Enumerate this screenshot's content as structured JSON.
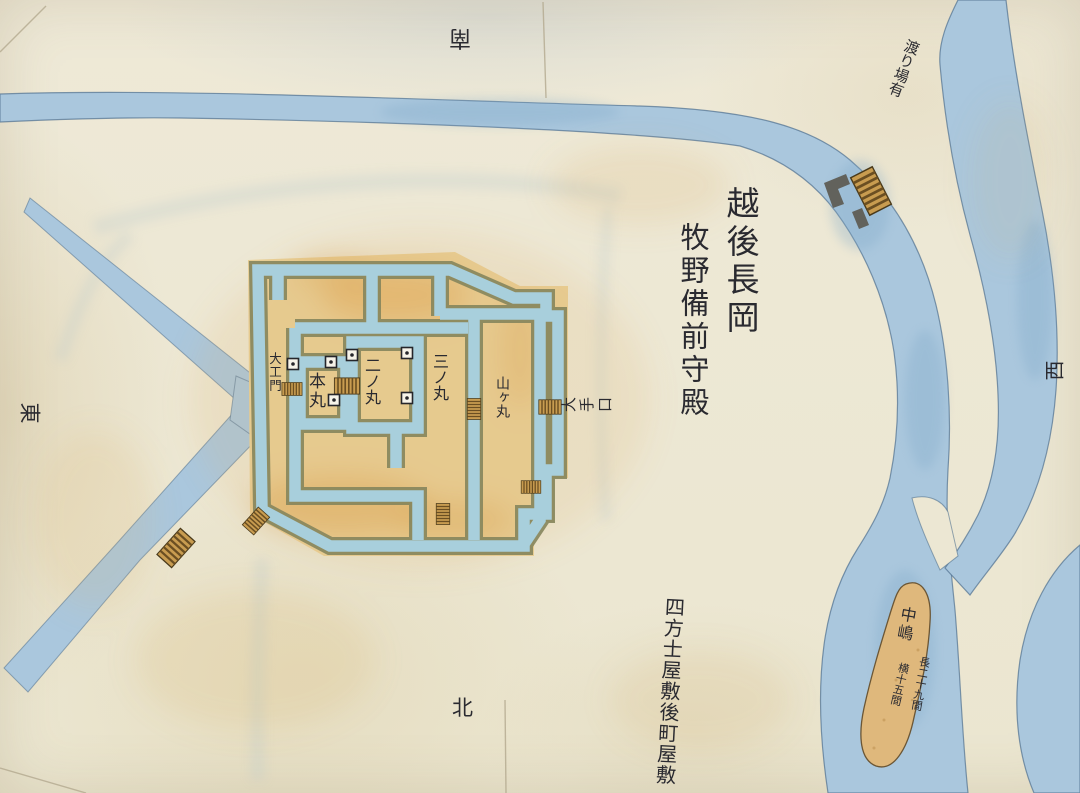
{
  "map": {
    "title": {
      "line1": "越後長岡",
      "line2": "牧野備前守殿"
    },
    "directions": {
      "top": "南",
      "bottom": "北",
      "left": "東",
      "right": "西"
    },
    "castle": {
      "west_gate": "大工門",
      "honmaru": "本丸",
      "ninomaru": "二ノ丸",
      "sannomaru": "三ノ丸",
      "yamagamaru": "山ヶ丸",
      "ote_guchi_chars": [
        "大",
        "手",
        "口"
      ]
    },
    "annotations": {
      "ferry_note": "渡り場有",
      "samurai_district": "四方士屋敷後町屋敷"
    },
    "island": {
      "name": "中嶋",
      "length_note": "長二十九間",
      "width_note": "横十五間"
    },
    "icons": {
      "turret": "turret-square-icon",
      "bridge": "hatched-bridge-icon",
      "gatehouse": "gatehouse-l-icon"
    }
  },
  "colors": {
    "paper": "#ece7d3",
    "river": "#aac7dd",
    "moat": "#a8cfdc",
    "wall": "#85855c",
    "ground": "#e8cf96",
    "island": "#dfb87c",
    "bridge": "#c89c50",
    "ink": "#2a2a30"
  }
}
